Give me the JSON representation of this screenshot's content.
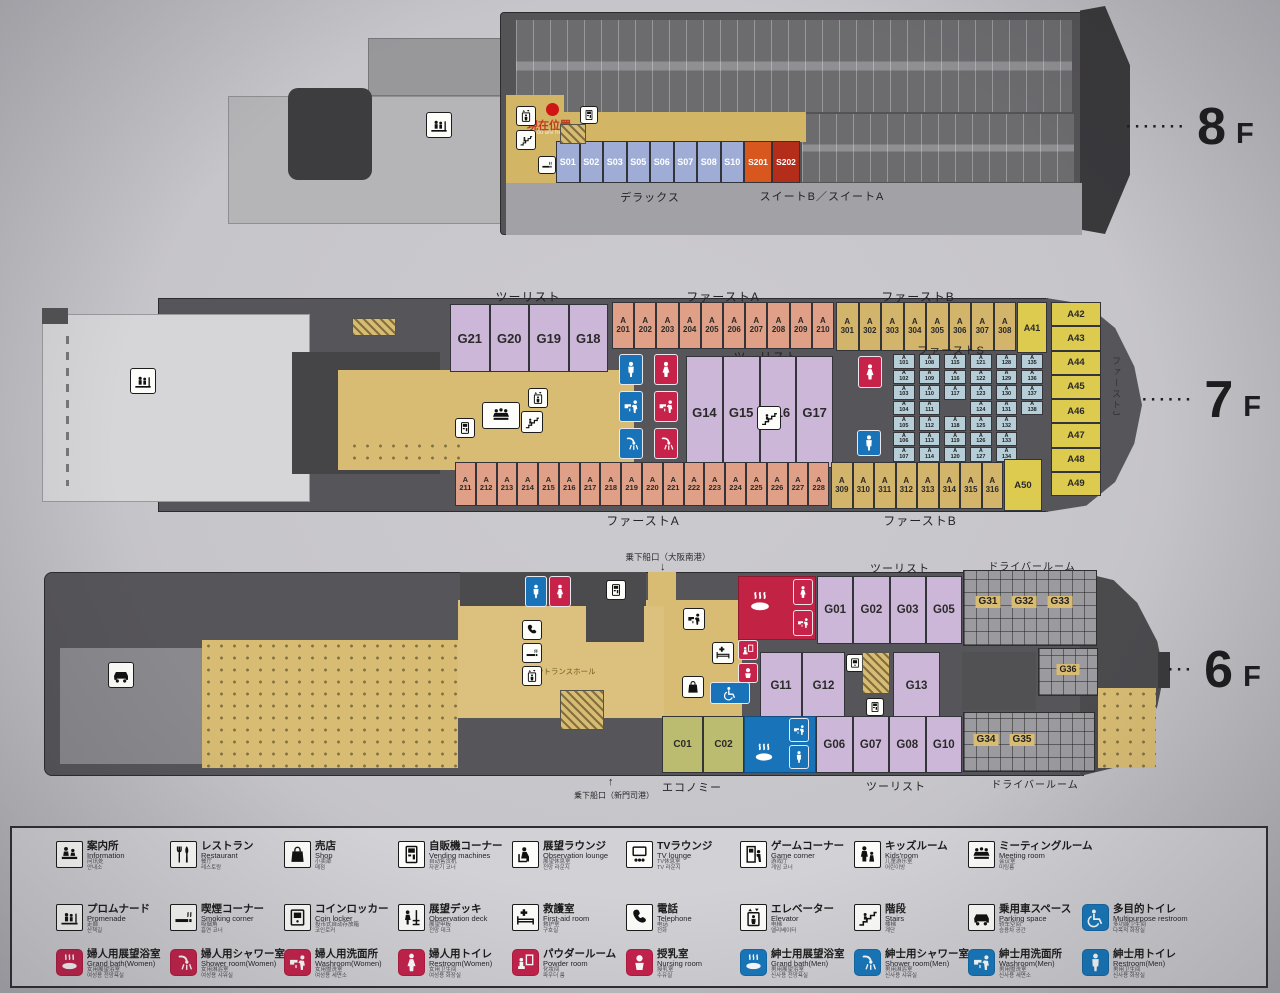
{
  "colors": {
    "cabin_s": "#9fadd6",
    "suite_b": "#d8571e",
    "suite_a": "#b42c1a",
    "tourist_purple": "#cdb7d8",
    "first_a_salmon": "#dfa087",
    "first_b_tan": "#d2b46a",
    "first_j_yellow": "#ddcb50",
    "first_s_cyan": "#b5ced8",
    "economy_olive": "#bcbc70",
    "corridor_tan": "#d8bc73",
    "hull_gray": "#565559",
    "icon_blue": "#1873b8",
    "icon_red": "#c7234a"
  },
  "decks": {
    "f8": {
      "floor": {
        "dots": "∙∙∙∙∙∙∙",
        "num": "8",
        "suffix": "F"
      },
      "you_are_here": {
        "jp": "現在位置",
        "en": "You are here"
      },
      "rooms_s": [
        "S01",
        "S02",
        "S03",
        "S05",
        "S06",
        "S07",
        "S08",
        "S10"
      ],
      "suites": [
        {
          "label": "S201",
          "cls": "rm-suite1"
        },
        {
          "label": "S202",
          "cls": "rm-suite2"
        }
      ],
      "zone_deluxe": "デラックス",
      "zone_suite": "スイートB／スイートA"
    },
    "f7": {
      "floor": {
        "dots": "∙∙∙∙∙∙",
        "num": "7",
        "suffix": "F"
      },
      "zones": {
        "tourist_top": "ツーリスト",
        "first_a_top": "ファーストA",
        "first_b_top": "ファーストB",
        "tourist_mid": "ツーリスト",
        "first_s": "ファーストS",
        "first_j": "ファーストJ",
        "first_a_bottom": "ファーストA",
        "first_b_bottom": "ファーストB"
      },
      "g_top": [
        "G21",
        "G20",
        "G19",
        "G18"
      ],
      "g_mid": [
        "G14",
        "G15",
        "G16",
        "G17"
      ],
      "a2_top": [
        "A201",
        "A202",
        "A203",
        "A204",
        "A205",
        "A206",
        "A207",
        "A208",
        "A209",
        "A210"
      ],
      "a3_top": [
        "A301",
        "A302",
        "A303",
        "A304",
        "A305",
        "A306",
        "A307",
        "A308"
      ],
      "a41": "A41",
      "a50": "A50",
      "right_col": [
        "A42",
        "A43",
        "A44",
        "A45",
        "A46",
        "A47",
        "A48",
        "A49"
      ],
      "grid": [
        "A101",
        "A102",
        "A103",
        "A104",
        "A105",
        "A106",
        "A107",
        "A108",
        "A109",
        "A110",
        "A111",
        "A112",
        "A113",
        "A114",
        "A115",
        "A116",
        "A117",
        "",
        "A118",
        "A119",
        "A120",
        "A121",
        "A122",
        "A123",
        "A124",
        "A125",
        "A126",
        "A127",
        "A128",
        "A129",
        "A130",
        "A131",
        "A132",
        "A133",
        "A134",
        "A135",
        "A136",
        "A137",
        "A138",
        "",
        "",
        ""
      ],
      "a2_bottom": [
        "A211",
        "A212",
        "A213",
        "A214",
        "A215",
        "A216",
        "A217",
        "A218",
        "A219",
        "A220",
        "A221",
        "A222",
        "A223",
        "A224",
        "A225",
        "A226",
        "A227",
        "A228"
      ],
      "a3_bottom": [
        "A309",
        "A310",
        "A311",
        "A312",
        "A313",
        "A314",
        "A315",
        "A316"
      ]
    },
    "f6": {
      "floor": {
        "dots": "∙∙∙",
        "num": "6",
        "suffix": "F"
      },
      "gates": {
        "top": "乗下船口（大阪南港）",
        "top_arrow": "↓",
        "bottom": "乗下船口（新門司港）",
        "bottom_arrow": "↑"
      },
      "zones": {
        "tourist_top": "ツーリスト",
        "driver_top": "ドライバールーム",
        "economy": "エコノミー",
        "tourist_bottom": "ツーリスト",
        "driver_bottom": "ドライバールーム",
        "entrance": "エントランスホール"
      },
      "g_row1": [
        "G01",
        "G02",
        "G03",
        "G05"
      ],
      "g11": "G11",
      "g12": "G12",
      "g13": "G13",
      "g31": "G31",
      "g32": "G32",
      "g33": "G33",
      "g34": "G34",
      "g35": "G35",
      "g36": "G36",
      "c_rooms": [
        "C01",
        "C02"
      ],
      "g_row3": [
        "G06",
        "G07",
        "G08",
        "G10"
      ]
    }
  },
  "legend": {
    "rows": [
      [
        {
          "icon": "sym-info",
          "tone": "outline",
          "jp": "案内所",
          "en": "Information",
          "cn": "问讯处",
          "kr": "안내소"
        },
        {
          "icon": "sym-restaurant",
          "tone": "outline",
          "jp": "レストラン",
          "en": "Restaurant",
          "cn": "餐厅",
          "kr": "레스토랑"
        },
        {
          "icon": "sym-bag",
          "tone": "outline",
          "jp": "売店",
          "en": "Shop",
          "cn": "小卖部",
          "kr": "매점"
        },
        {
          "icon": "sym-vending",
          "tone": "outline",
          "jp": "自販機コーナー",
          "en": "Vending machines",
          "cn": "自动售货机",
          "kr": "자판기 코너"
        },
        {
          "icon": "sym-lounge",
          "tone": "outline",
          "jp": "展望ラウンジ",
          "en": "Observation lounge",
          "cn": "展望休息室",
          "kr": "전망 라운지"
        },
        {
          "icon": "sym-tv",
          "tone": "outline",
          "jp": "TVラウンジ",
          "en": "TV lounge",
          "cn": "TV休息室",
          "kr": "TV 라운지"
        },
        {
          "icon": "sym-game",
          "tone": "outline",
          "jp": "ゲームコーナー",
          "en": "Game corner",
          "cn": "游戏厅",
          "kr": "게임 코너"
        },
        {
          "icon": "sym-kids",
          "tone": "outline",
          "jp": "キッズルーム",
          "en": "Kids'room",
          "cn": "儿童游乐室",
          "kr": "어린이방"
        },
        {
          "icon": "sym-meeting",
          "tone": "outline",
          "jp": "ミーティングルーム",
          "en": "Meeting room",
          "cn": "会议室",
          "kr": "미팅룸"
        }
      ],
      [
        {
          "icon": "sym-promenade",
          "tone": "outline",
          "jp": "プロムナード",
          "en": "Promenade",
          "cn": "走廊",
          "kr": "산책길"
        },
        {
          "icon": "sym-smoking",
          "tone": "outline",
          "jp": "喫煙コーナー",
          "en": "Smoking corner",
          "cn": "吸烟角",
          "kr": "흡연 코너"
        },
        {
          "icon": "sym-locker",
          "tone": "outline",
          "jp": "コインロッカー",
          "en": "Coin locker",
          "cn": "投币式自动存放箱",
          "kr": "코인로커"
        },
        {
          "icon": "sym-deckrail",
          "tone": "outline",
          "jp": "展望デッキ",
          "en": "Observation deck",
          "cn": "展望甲板",
          "kr": "전망 데크"
        },
        {
          "icon": "sym-bed",
          "tone": "outline",
          "jp": "救護室",
          "en": "First-aid room",
          "cn": "救护室",
          "kr": "구호실"
        },
        {
          "icon": "sym-phone",
          "tone": "outline",
          "jp": "電話",
          "en": "Telephone",
          "cn": "电话",
          "kr": "전화"
        },
        {
          "icon": "sym-elevator",
          "tone": "outline",
          "jp": "エレベーター",
          "en": "Elevator",
          "cn": "电梯",
          "kr": "엘리베이터"
        },
        {
          "icon": "sym-stairs",
          "tone": "outline",
          "jp": "階段",
          "en": "Stairs",
          "cn": "楼梯",
          "kr": "계단"
        },
        {
          "icon": "sym-car",
          "tone": "outline",
          "jp": "乗用車スペース",
          "en": "Parking space",
          "cn": "轿车空间",
          "kr": "승용차 공간"
        },
        {
          "icon": "sym-wheelchair",
          "tone": "blue",
          "jp": "多目的トイレ",
          "en": "Multipurpose restroom",
          "cn": "多功能卫生间",
          "kr": "다목적 화장실"
        }
      ],
      [
        {
          "icon": "sym-bath",
          "tone": "red",
          "jp": "婦人用展望浴室",
          "en": "Grand bath(Women)",
          "cn": "女用展望浴室",
          "kr": "여성용 전망욕실"
        },
        {
          "icon": "sym-shower",
          "tone": "red",
          "jp": "婦人用シャワー室",
          "en": "Shower room(Women)",
          "cn": "女用淋浴室",
          "kr": "여성용 샤워실"
        },
        {
          "icon": "sym-washroom",
          "tone": "red",
          "jp": "婦人用洗面所",
          "en": "Washroom(Women)",
          "cn": "女用盥洗室",
          "kr": "여성용 세면소"
        },
        {
          "icon": "sym-woman",
          "tone": "red",
          "jp": "婦人用トイレ",
          "en": "Restroom(Women)",
          "cn": "女用卫生间",
          "kr": "여성용 화장실"
        },
        {
          "icon": "sym-powder",
          "tone": "red",
          "jp": "パウダールーム",
          "en": "Powder room",
          "cn": "化妆间",
          "kr": "파우더 룸"
        },
        {
          "icon": "sym-baby",
          "tone": "red",
          "jp": "授乳室",
          "en": "Nursing room",
          "cn": "授乳室",
          "kr": "수유실"
        },
        {
          "icon": "sym-bath",
          "tone": "blue",
          "jp": "紳士用展望浴室",
          "en": "Grand bath(Men)",
          "cn": "男用展望浴室",
          "kr": "신사용 전망욕실"
        },
        {
          "icon": "sym-shower",
          "tone": "blue",
          "jp": "紳士用シャワー室",
          "en": "Shower room(Men)",
          "cn": "男用淋浴室",
          "kr": "신사용 샤워실"
        },
        {
          "icon": "sym-washroom",
          "tone": "blue",
          "jp": "紳士用洗面所",
          "en": "Washroom(Men)",
          "cn": "男用盥洗室",
          "kr": "신사용 세면소"
        },
        {
          "icon": "sym-man",
          "tone": "blue",
          "jp": "紳士用トイレ",
          "en": "Restroom(Men)",
          "cn": "男用卫生间",
          "kr": "신사용 화장실"
        }
      ]
    ]
  }
}
